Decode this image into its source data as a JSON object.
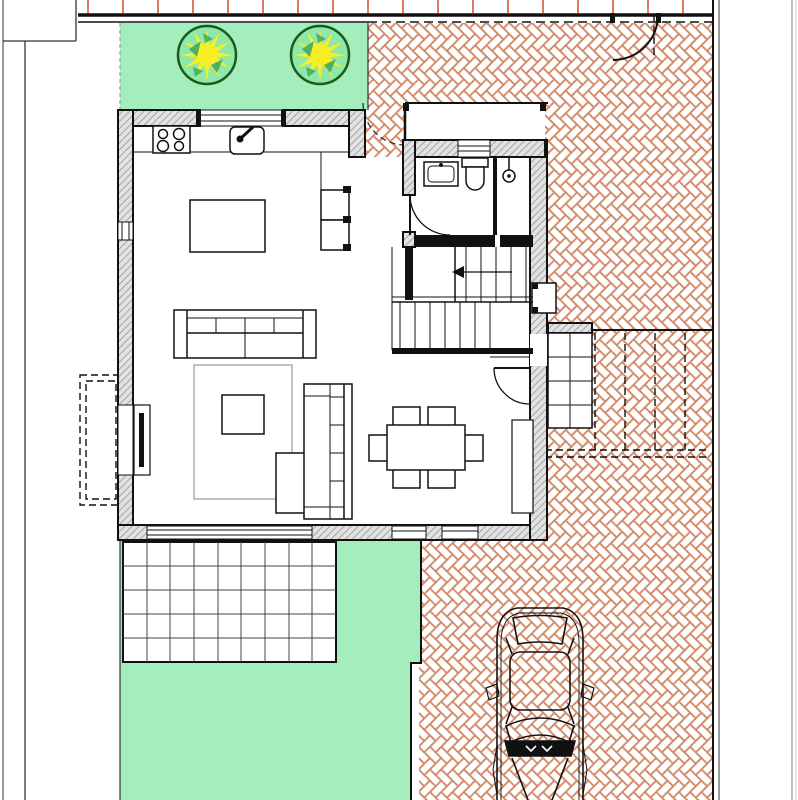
{
  "document": {
    "kind": "architectural-floor-plan",
    "visible_text": [],
    "palette": {
      "lawn": "#a4edbc",
      "paving_line": "#d28a68",
      "ink": "#111111",
      "hatch_bg": "#e2e2e2",
      "hatch_line": "#8c8c8c",
      "fence_tick": "#e07a58",
      "tree_outline": "#1c5a1c",
      "tree_fill": "#8fe8a8",
      "tree_star": "#f7ef25",
      "tree_accent": "#3aa45f",
      "page_bg": "#ffffff",
      "border_gray": "#999999",
      "rug": "#9a9a9a"
    },
    "features": {
      "trees": 2,
      "fence_ticks": 18,
      "patio_grid": {
        "cols": 9,
        "rows": 5
      },
      "dining_chairs": 6,
      "stove_burners": 4,
      "pergola_dashed_posts": 4,
      "car_present": true
    }
  }
}
